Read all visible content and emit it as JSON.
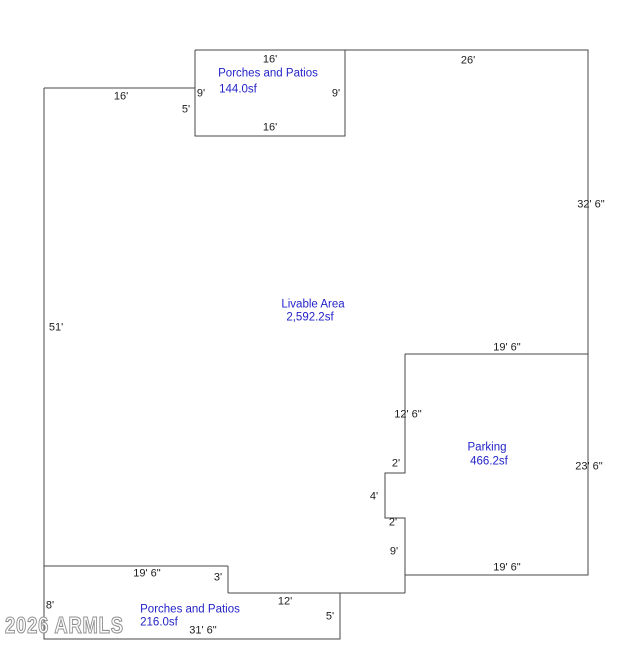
{
  "colors": {
    "background": "#ffffff",
    "line": "#474747",
    "dim_text": "#1c1c1c",
    "area_text": "#2323c8",
    "watermark": "#8f8f8f"
  },
  "watermark": {
    "text": "2026 ARMLS"
  },
  "areas": {
    "porch_top": {
      "name": "Porches and Patios",
      "size": "144.0sf"
    },
    "livable": {
      "name": "Livable Area",
      "size": "2,592.2sf"
    },
    "parking": {
      "name": "Parking",
      "size": "466.2sf"
    },
    "porch_bottom": {
      "name": "Porches and Patios",
      "size": "216.0sf"
    }
  },
  "dims": {
    "porch_top_width_top": "16'",
    "main_top_width": "26'",
    "porch_left_height": "9'",
    "porch_right_height": "9'",
    "porch_left_lower": "5'",
    "porch_bottom_width": "16'",
    "livable_top_width": "16'",
    "right_side_upper": "32' 6\"",
    "left_side": "51'",
    "parking_top_width": "19' 6\"",
    "parking_left_height": "12' 6\"",
    "right_side_lower": "23' 6\"",
    "notch_top": "2'",
    "notch_left": "4'",
    "notch_bottom": "2'",
    "parking_left_lower": "9'",
    "parking_bottom_width": "19' 6\"",
    "livable_bottom_width": "19' 6\"",
    "bottom_step": "3'",
    "porch2_top_width": "12'",
    "porch2_left_height": "8'",
    "porch2_bottom_width": "31' 6\"",
    "porch2_right_height": "5'"
  }
}
